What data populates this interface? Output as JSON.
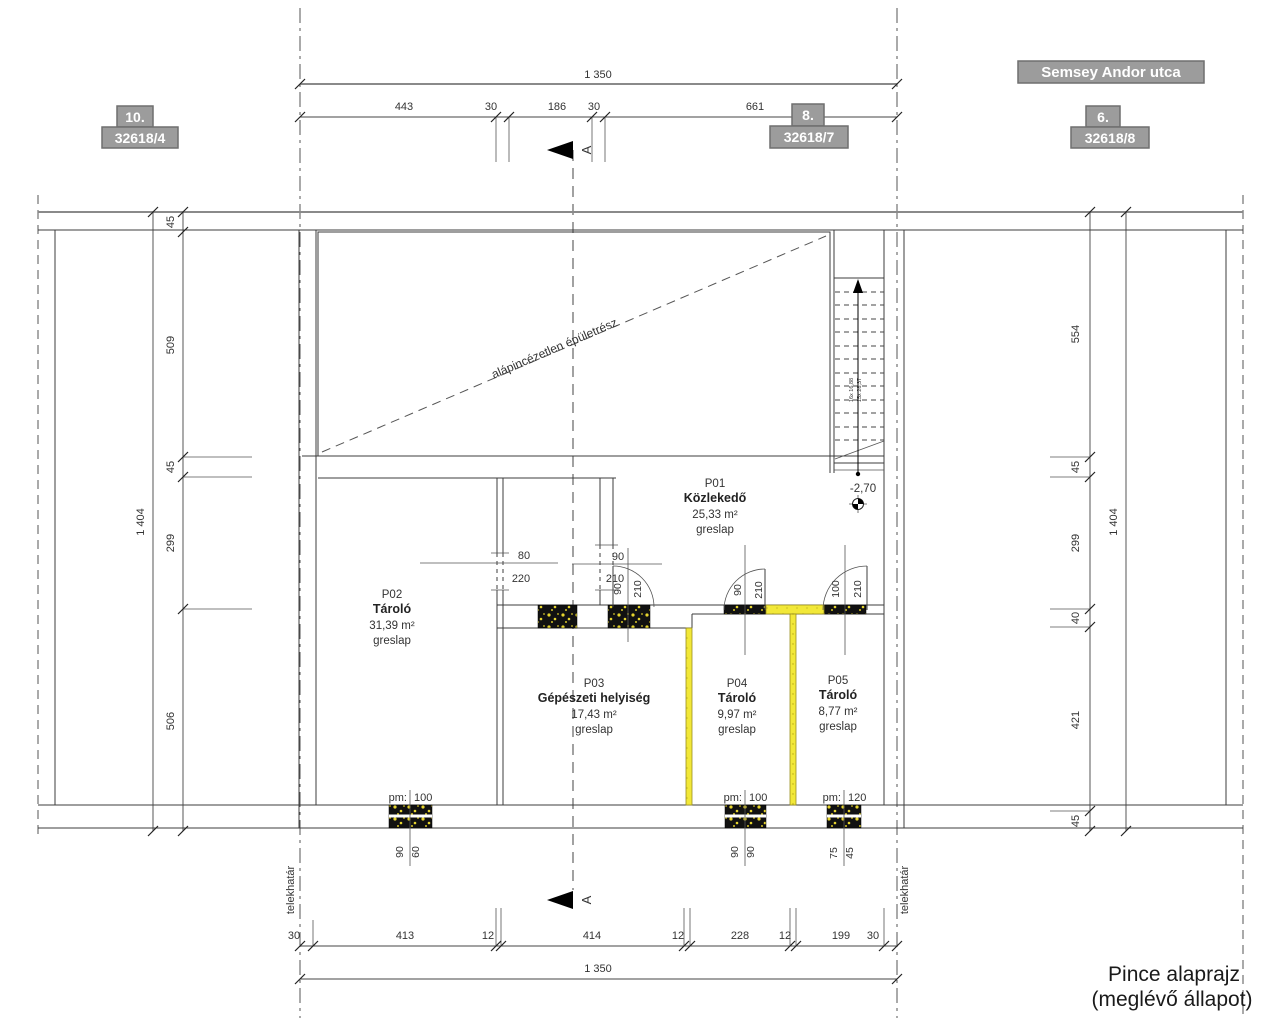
{
  "street": {
    "label": "Semsey Andor utca"
  },
  "plots": [
    {
      "house_no": "10.",
      "parcel": "32618/4"
    },
    {
      "house_no": "8.",
      "parcel": "32618/7"
    },
    {
      "house_no": "6.",
      "parcel": "32618/8"
    }
  ],
  "title": {
    "line1": "Pince alaprajz",
    "line2": "(meglévő állapot)"
  },
  "rooms": [
    {
      "id": "P01",
      "name": "Közlekedő",
      "area": "25,33 m²",
      "floor": "greslap"
    },
    {
      "id": "P02",
      "name": "Tároló",
      "area": "31,39 m²",
      "floor": "greslap"
    },
    {
      "id": "P03",
      "name": "Gépészeti helyiség",
      "area": "17,43 m²",
      "floor": "greslap"
    },
    {
      "id": "P04",
      "name": "Tároló",
      "area": "9,97 m²",
      "floor": "greslap"
    },
    {
      "id": "P05",
      "name": "Tároló",
      "area": "8,77 m²",
      "floor": "greslap"
    }
  ],
  "annotations": {
    "no_basement": "alápincézetlen épületrész",
    "level": "-2,70",
    "boundary": "telekhatár",
    "section_letter": "A",
    "stair_text_1": "16x 16,88",
    "stair_text_2": "15x 28,37"
  },
  "dims": {
    "top_total": "1 350",
    "bottom_total": "1 350",
    "side_total": "1 404",
    "top_chain": [
      "443",
      "30",
      "186",
      "30",
      "661"
    ],
    "bottom_chain": [
      "30",
      "413",
      "12",
      "414",
      "12",
      "228",
      "12",
      "199",
      "30"
    ],
    "left_chain": [
      "45",
      "509",
      "45",
      "299",
      "506"
    ],
    "right_chain": [
      "554",
      "45",
      "299",
      "40",
      "421",
      "45"
    ],
    "opening1": {
      "w": "80",
      "h": "220"
    },
    "opening2": {
      "w": "90",
      "h": "210"
    },
    "door1": {
      "w": "90",
      "h": "210"
    },
    "door2": {
      "w": "90",
      "h": "210"
    },
    "door3": {
      "w": "100",
      "h": "210"
    },
    "window1": {
      "pm": "pm:",
      "pm_value": "100",
      "d1": "90",
      "d2": "60"
    },
    "window2": {
      "pm": "pm:",
      "pm_value": "100",
      "d1": "90",
      "d2": "90"
    },
    "window3": {
      "pm": "pm:",
      "pm_value": "120",
      "d1": "75",
      "d2": "45"
    }
  },
  "colors": {
    "wall_yellow": "#f2e838",
    "pier": "#111111",
    "label_bg": "#9c9c9c"
  }
}
